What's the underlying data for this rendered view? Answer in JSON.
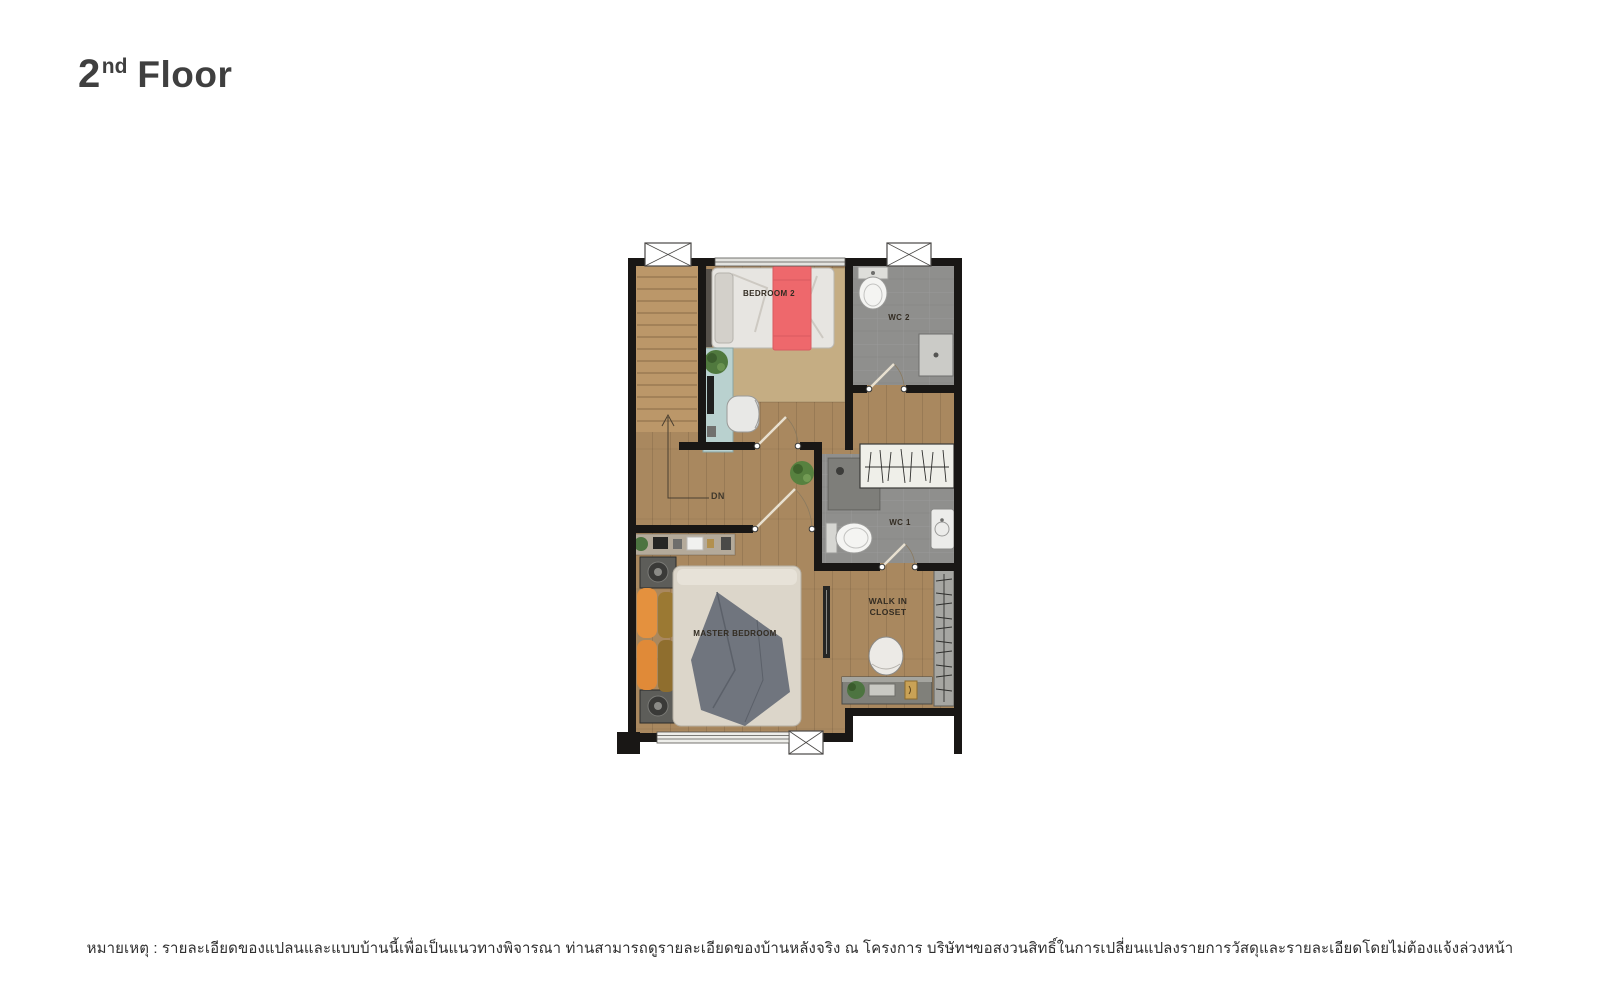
{
  "header": {
    "floor_label": {
      "number": "2",
      "ordinal_suffix": "nd",
      "word": "Floor"
    }
  },
  "floor_plan": {
    "room_labels": {
      "bedroom2": "BEDROOM 2",
      "wc2": "WC 2",
      "wc1": "WC 1",
      "master_bedroom": "MASTER BEDROOM",
      "walk_in_closet": "WALK IN CLOSET",
      "stairs_direction": "DN"
    },
    "colors": {
      "wall": "#191715",
      "wood_floor": "#a9885f",
      "stair_wood": "#bb9769",
      "tile_floor": "#8e8e8c",
      "bed2_runner_red": "#ee686c",
      "master_pillow_orange": "#e4913e",
      "desk_teal": "#b9d1cf",
      "master_throw_gray": "#70757e"
    }
  },
  "footer": {
    "note": "หมายเหตุ : รายละเอียดของแปลนและแบบบ้านนี้เพื่อเป็นแนวทางพิจารณา ท่านสามารถดูรายละเอียดของบ้านหลังจริง ณ โครงการ บริษัทฯขอสงวนสิทธิ์ในการเปลี่ยนแปลงรายการวัสดุและรายละเอียดโดยไม่ต้องแจ้งล่วงหน้า"
  }
}
